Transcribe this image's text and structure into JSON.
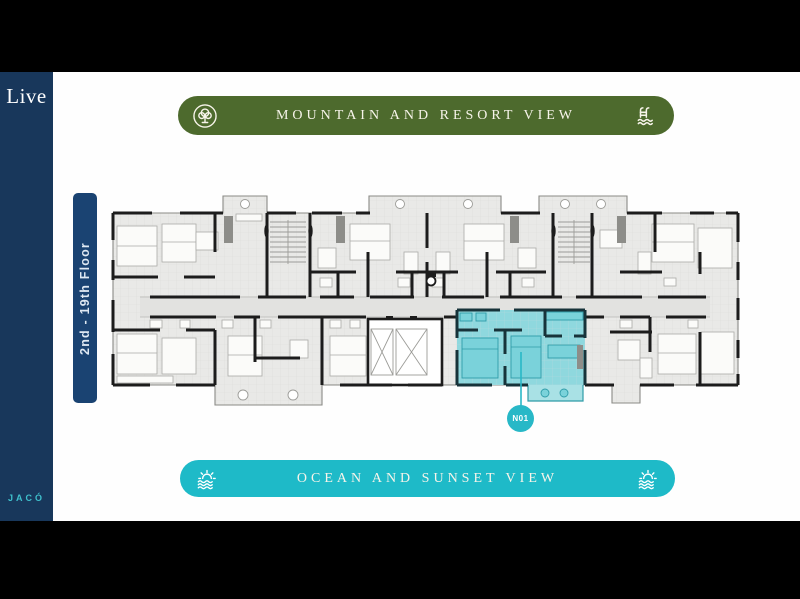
{
  "brand": {
    "logo": "Live",
    "location": "JACÓ"
  },
  "floor_label": {
    "text": "2nd - 19th Floor"
  },
  "banners": {
    "top": {
      "label": "MOUNTAIN AND RESORT VIEW",
      "color": "#4d6a2d",
      "left_icon": "tree-icon",
      "right_icon": "pool-ladder-icon"
    },
    "bottom": {
      "label": "OCEAN AND SUNSET VIEW",
      "color": "#1ebac8",
      "left_icon": "sunset-waves-icon",
      "right_icon": "sunset-waves-icon"
    }
  },
  "floorplan": {
    "highlighted_unit": {
      "id": "N01",
      "fill": "#8fd8de",
      "badge_color": "#28b8c7"
    }
  },
  "colors": {
    "letterbox": "#000000",
    "sidebar_bg": "#18375b",
    "floor_label_bg": "#1a4372",
    "plan_floor": "#e9e9e7",
    "plan_walls": "#1c1c1c"
  }
}
